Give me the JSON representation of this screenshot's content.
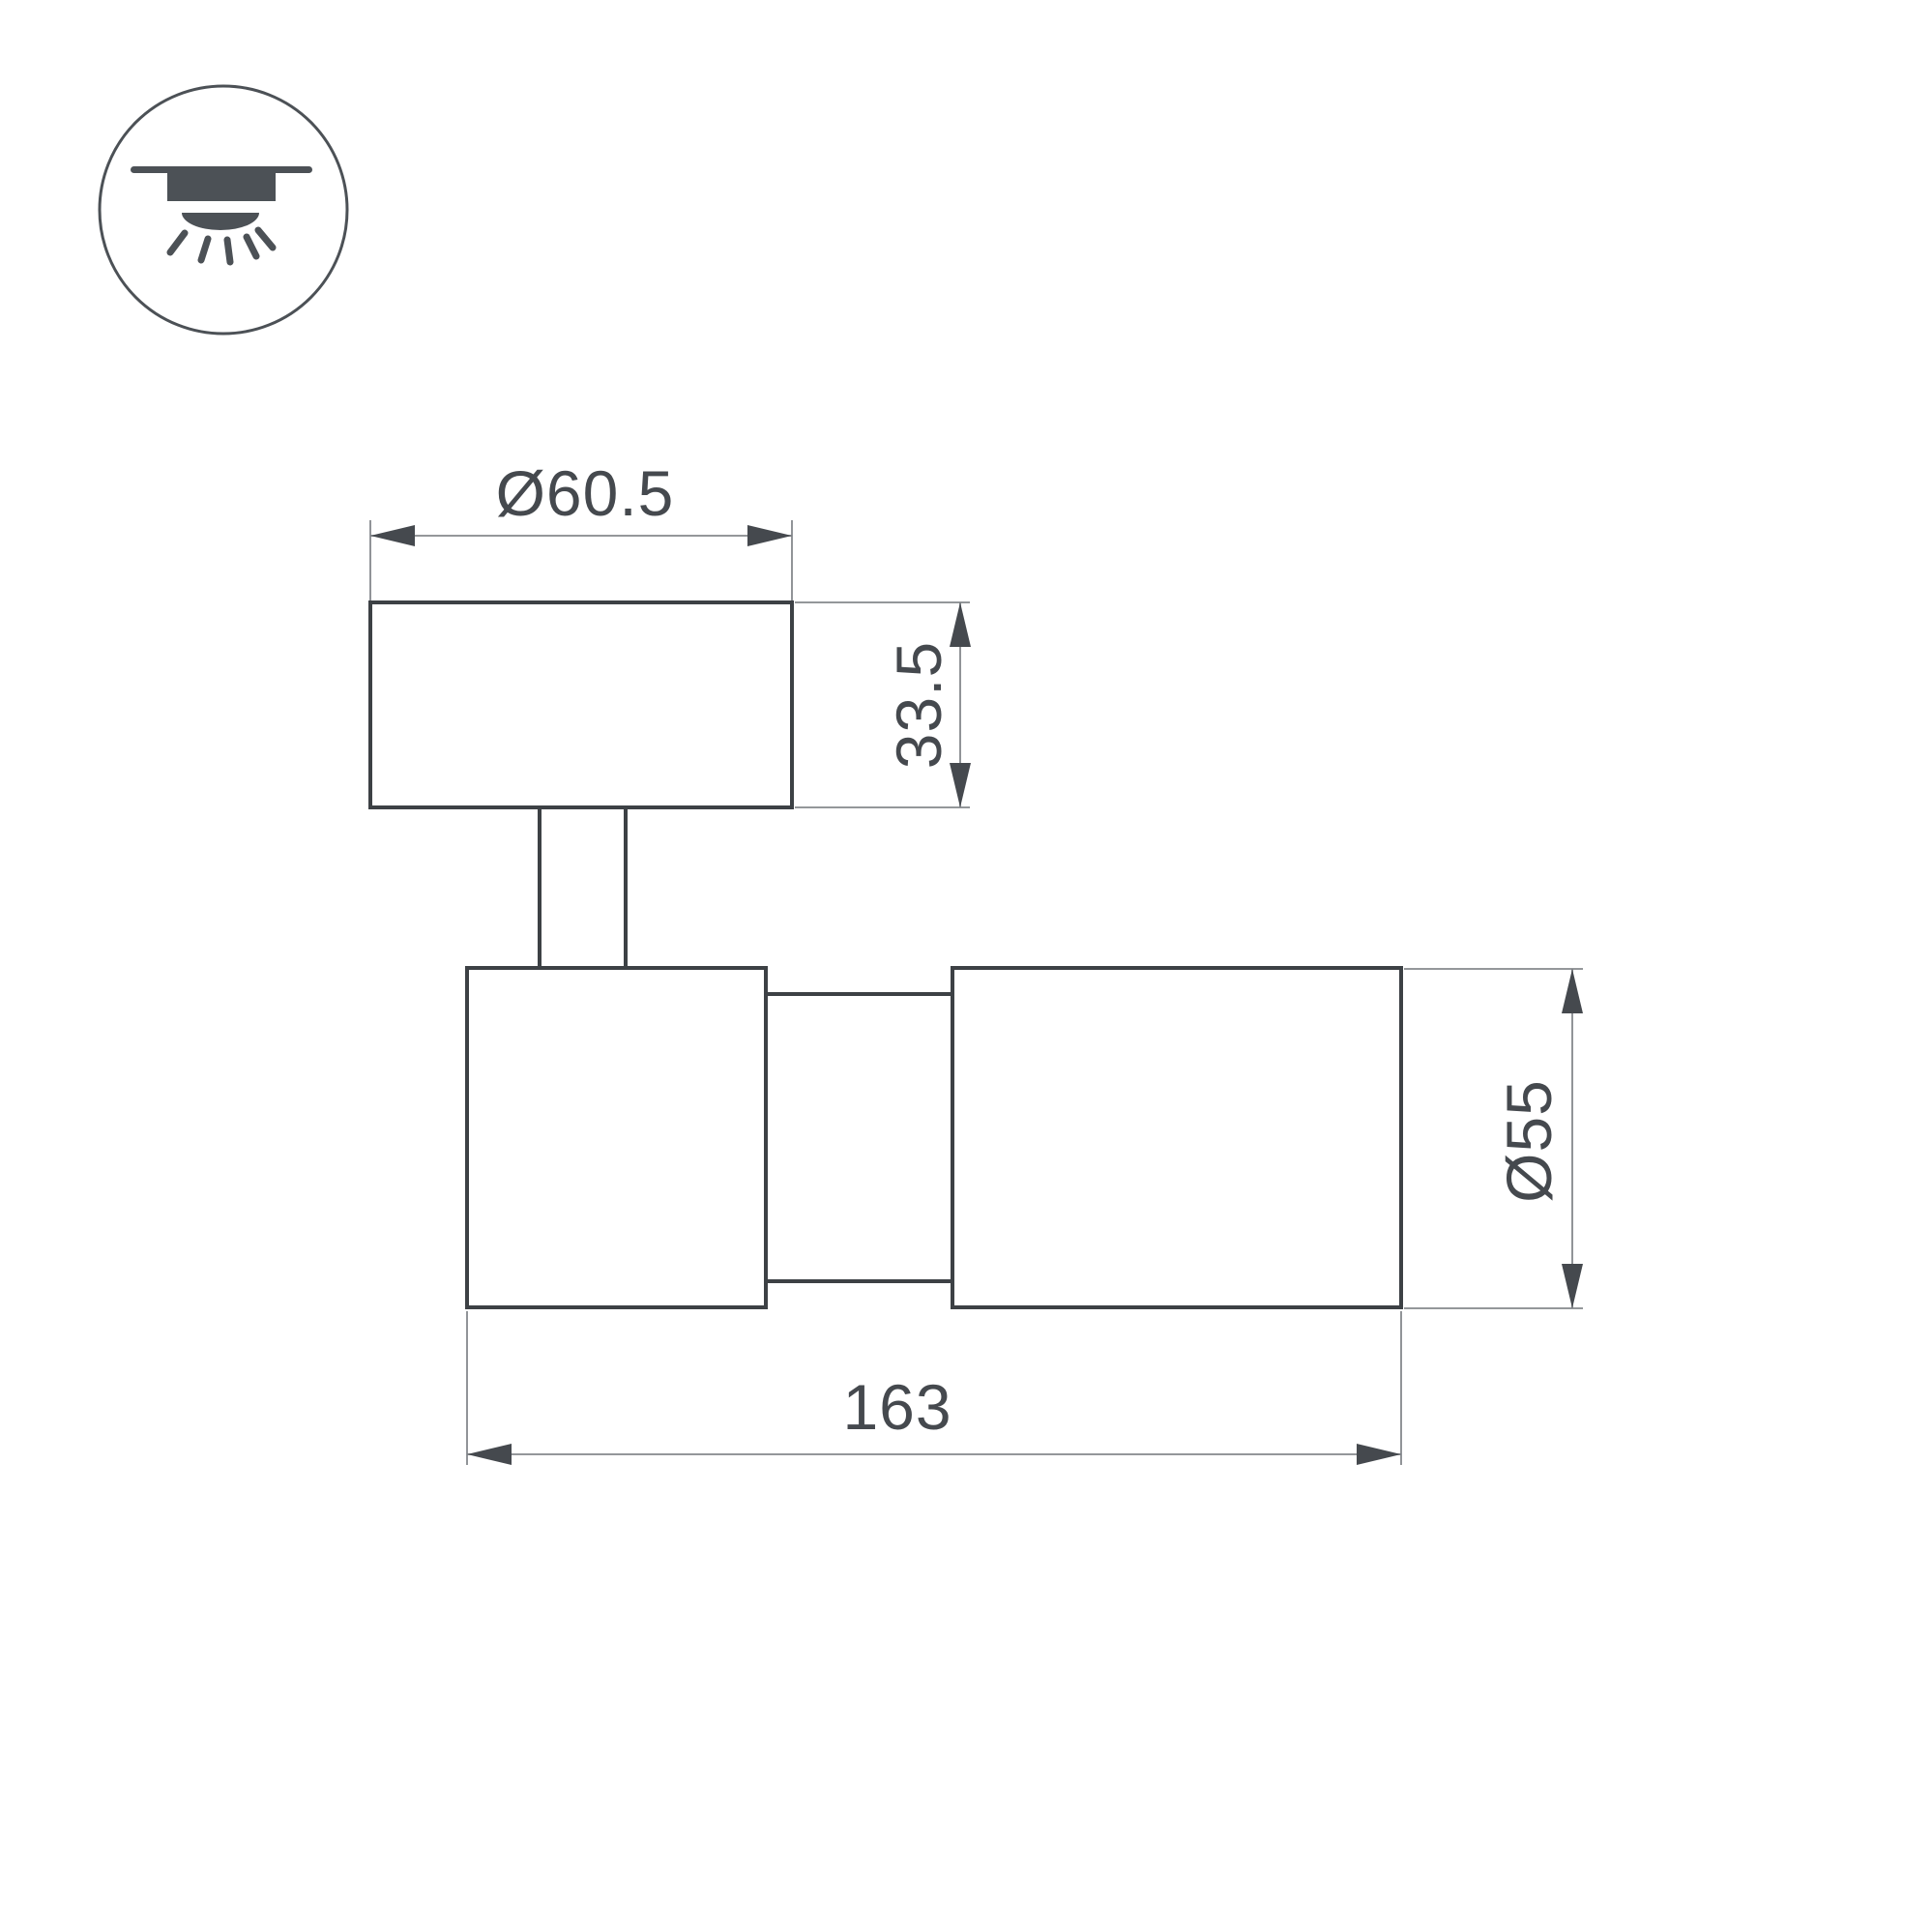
{
  "canvas": {
    "background": "#ffffff"
  },
  "icon": {
    "name": "ceiling-mount-downlight",
    "color": "#4c5156"
  },
  "drawing": {
    "colors": {
      "outline": "#3d4145",
      "dimension_line": "#85888c",
      "text": "#45494e"
    },
    "dimensions": {
      "top_diameter": {
        "label": "Ø60.5"
      },
      "cap_height": {
        "label": "33.5"
      },
      "body_diameter": {
        "label": "Ø55"
      },
      "body_length": {
        "label": "163"
      }
    }
  }
}
